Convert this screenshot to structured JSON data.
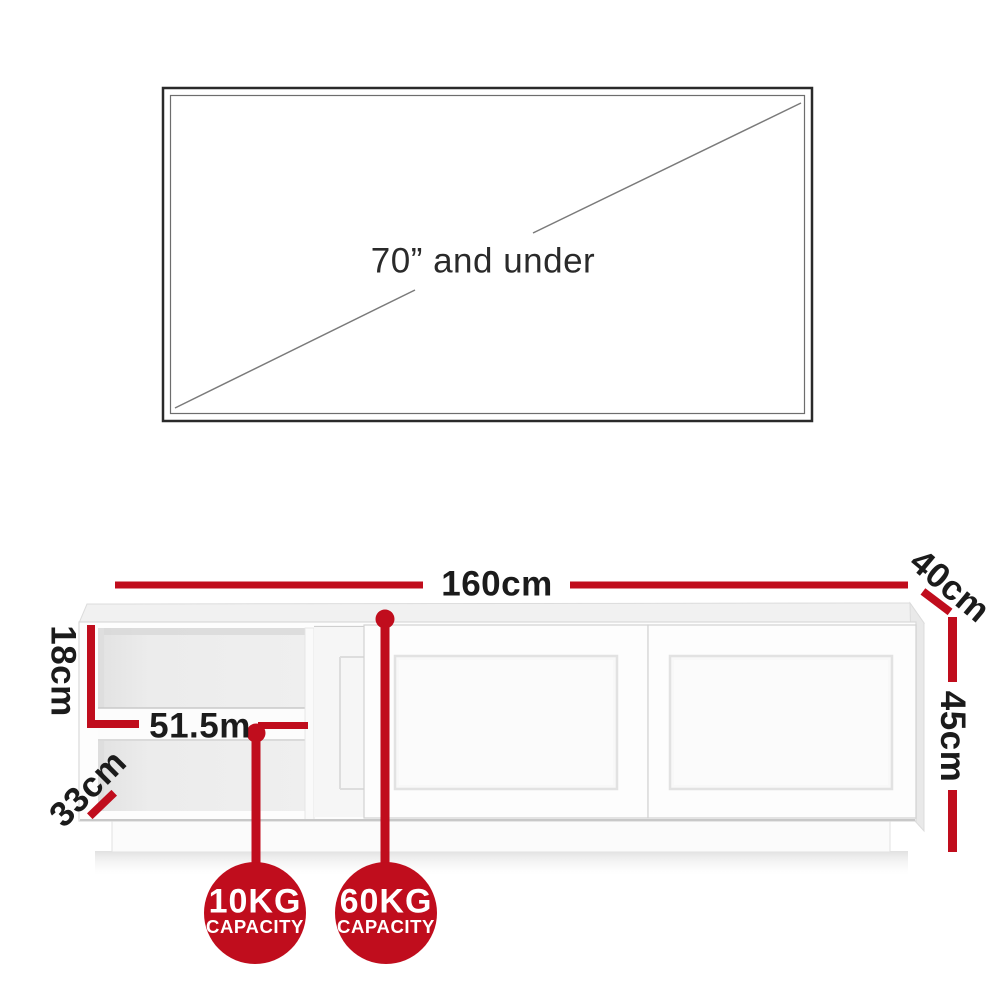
{
  "colors": {
    "accent_red": "#c00d1d",
    "label_dark": "#1b1b1b",
    "tv_text": "#2a2a2a",
    "badge_text": "#ffffff"
  },
  "tv": {
    "label": "70” and under"
  },
  "dimensions": {
    "width_label": "160cm",
    "depth_label": "40cm",
    "height_label": "45cm",
    "shelf_height_label": "18cm",
    "shelf_depth_label": "33cm",
    "shelf_width_label": "51.5m"
  },
  "badges": [
    {
      "weight": "10KG",
      "capacity_label": "CAPACITY"
    },
    {
      "weight": "60KG",
      "capacity_label": "CAPACITY"
    }
  ]
}
